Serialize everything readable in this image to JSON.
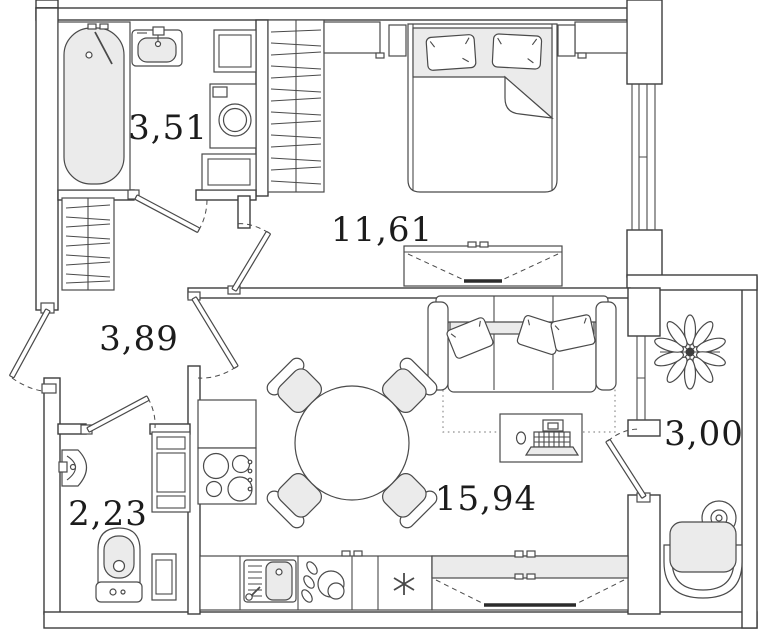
{
  "floor_plan": {
    "rooms": [
      {
        "id": "bathroom",
        "area_label": "3,51"
      },
      {
        "id": "bedroom",
        "area_label": "11,61"
      },
      {
        "id": "hallway",
        "area_label": "3,89"
      },
      {
        "id": "toilet",
        "area_label": "2,23"
      },
      {
        "id": "kitchen_living_room",
        "area_label": "15,94"
      },
      {
        "id": "balcony",
        "area_label": "3,00"
      }
    ],
    "colors": {
      "wall_line": "#3d3d3d",
      "furniture_line": "#4a4a4a",
      "light_fill": "#ebebeb",
      "background": "#ffffff",
      "label_text": "#1c1c1c"
    },
    "symbols": [
      "bathtub",
      "washbasin",
      "washing-machine",
      "towel-cabinet",
      "shelf",
      "wardrobe-hatched",
      "double-bed",
      "pillow",
      "nightstand",
      "tv-unit",
      "sofa",
      "desk-with-laptop",
      "rug-dotted",
      "round-dining-table",
      "chair",
      "stove-hob",
      "kitchen-sink",
      "dish-rack",
      "fridge-snowflake",
      "corner-washbasin",
      "toilet",
      "shelving-unit",
      "plant",
      "round-side-table",
      "armchair",
      "window",
      "door-swing"
    ]
  }
}
